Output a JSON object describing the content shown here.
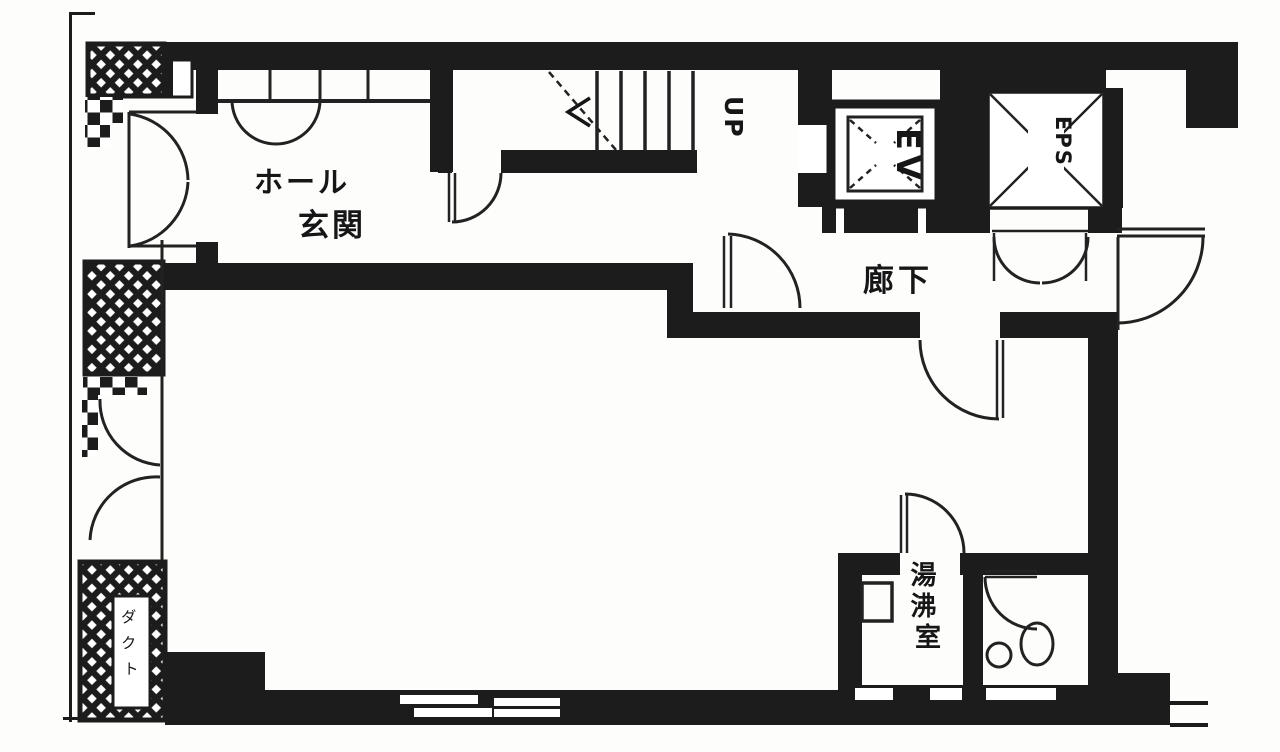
{
  "document": {
    "kind_label": "建物平面図",
    "floor_label": ""
  },
  "colors": {
    "wall": "#1c1c1c",
    "line": "#222222",
    "background": "#fdfdfc",
    "paper": "#ffffff"
  },
  "rooms": {
    "entrance_hall": {
      "label": "玄関ホール",
      "line1": "ホール",
      "line2": "玄関"
    },
    "corridor": {
      "label": "廊下"
    },
    "kitchenette": {
      "label": "湯沸室",
      "chars": [
        "湯",
        "沸",
        "室"
      ]
    },
    "stairs": {
      "direction_label": "UP"
    },
    "elevator": {
      "label": "EV"
    },
    "eps_shaft": {
      "label": "EPS"
    },
    "duct_shaft": {
      "label": "ダクト",
      "chars": [
        "ダ",
        "ク",
        "ト"
      ]
    }
  }
}
